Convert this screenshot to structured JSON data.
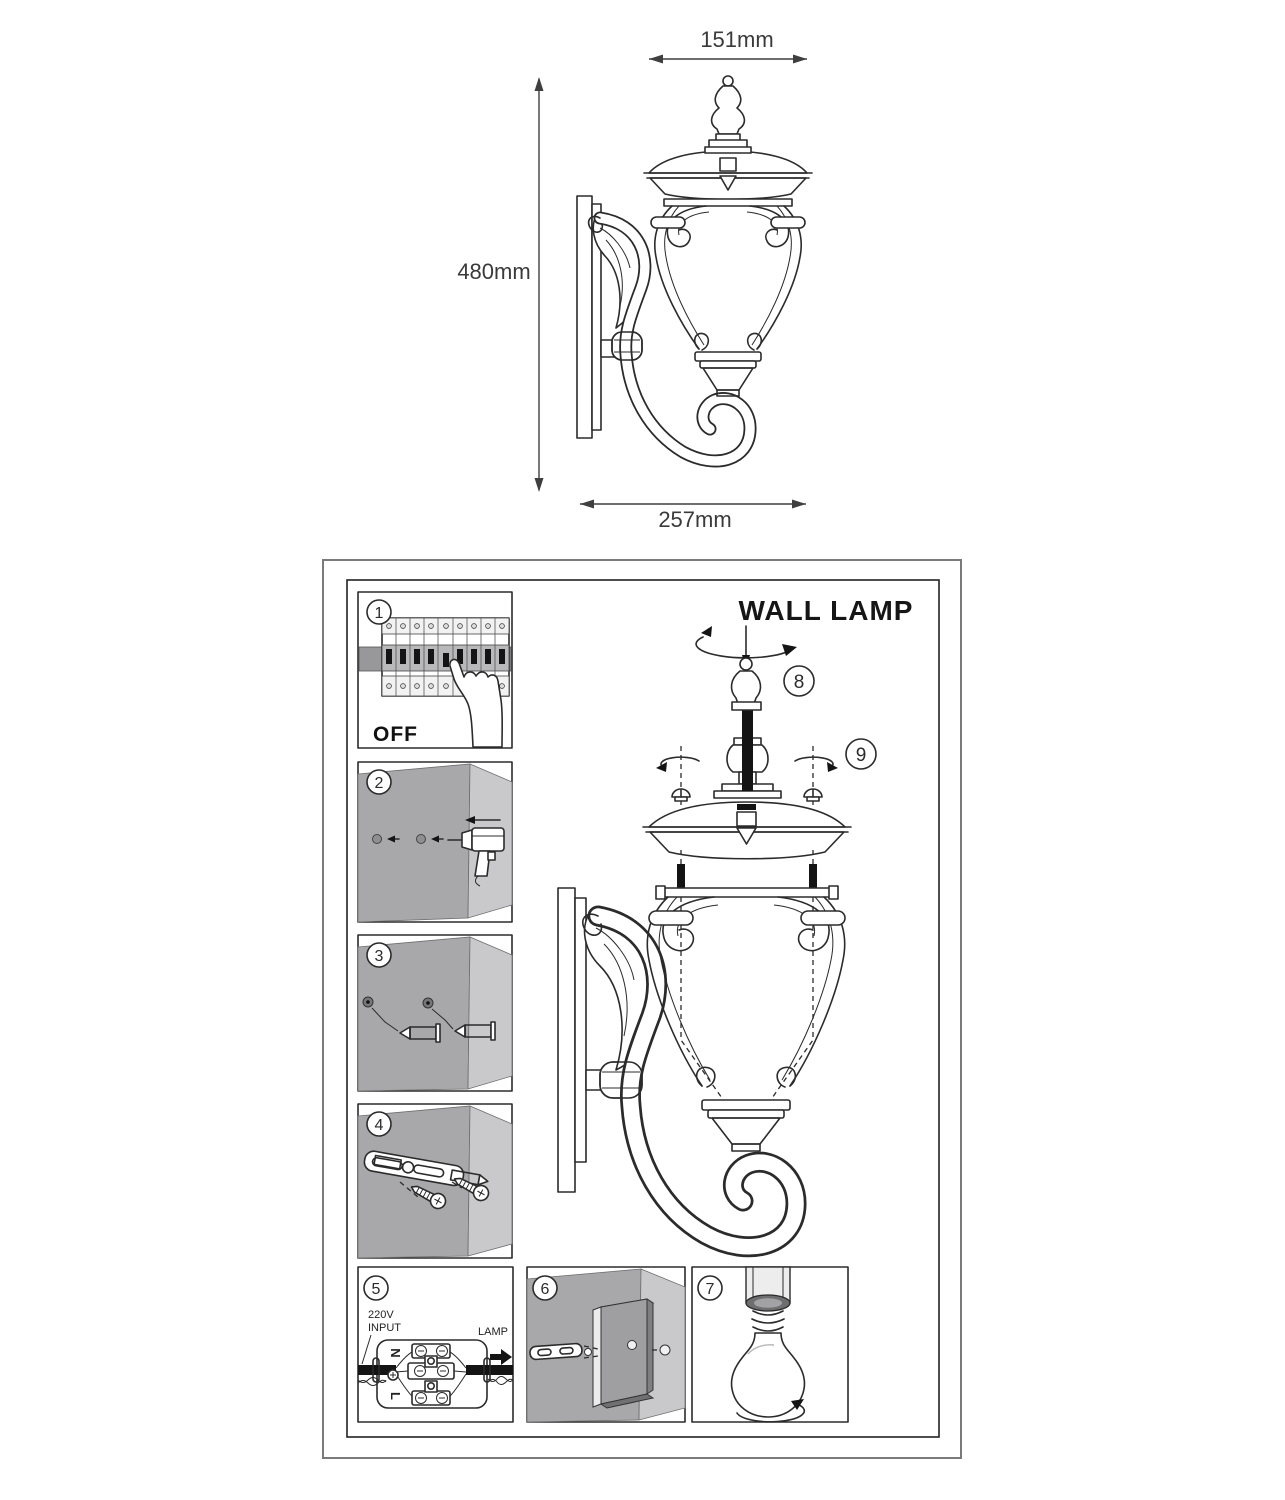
{
  "colors": {
    "line": "#2b2b2b",
    "dimension_text": "#3a3a3a",
    "wall_shadow": "#a8a8aa",
    "wall_light": "#c9c9cb",
    "metal_black": "#141414",
    "rail_gray": "#98989a"
  },
  "dimension_drawing": {
    "top_width_label": "151mm",
    "height_label": "480mm",
    "bottom_width_label": "257mm",
    "illustration": "wall-lamp-side-view"
  },
  "instructions": {
    "title": "WALL LAMP",
    "steps": [
      {
        "num": "1",
        "label": "OFF",
        "illustration": "circuit-breaker-switch-off"
      },
      {
        "num": "2",
        "illustration": "drill-holes-in-wall"
      },
      {
        "num": "3",
        "illustration": "insert-wall-anchors"
      },
      {
        "num": "4",
        "illustration": "fix-mounting-bracket-with-screws"
      },
      {
        "num": "5",
        "illustration": "terminal-block-wiring",
        "labels": {
          "input_line1": "220V",
          "input_line2": "INPUT",
          "neutral": "N",
          "live": "L",
          "lamp": "LAMP"
        }
      },
      {
        "num": "6",
        "illustration": "mount-backplate-on-wall"
      },
      {
        "num": "7",
        "illustration": "screw-in-bulb"
      },
      {
        "num": "8",
        "illustration": "attach-top-finial"
      },
      {
        "num": "9",
        "illustration": "tighten-cap-screws"
      }
    ]
  }
}
